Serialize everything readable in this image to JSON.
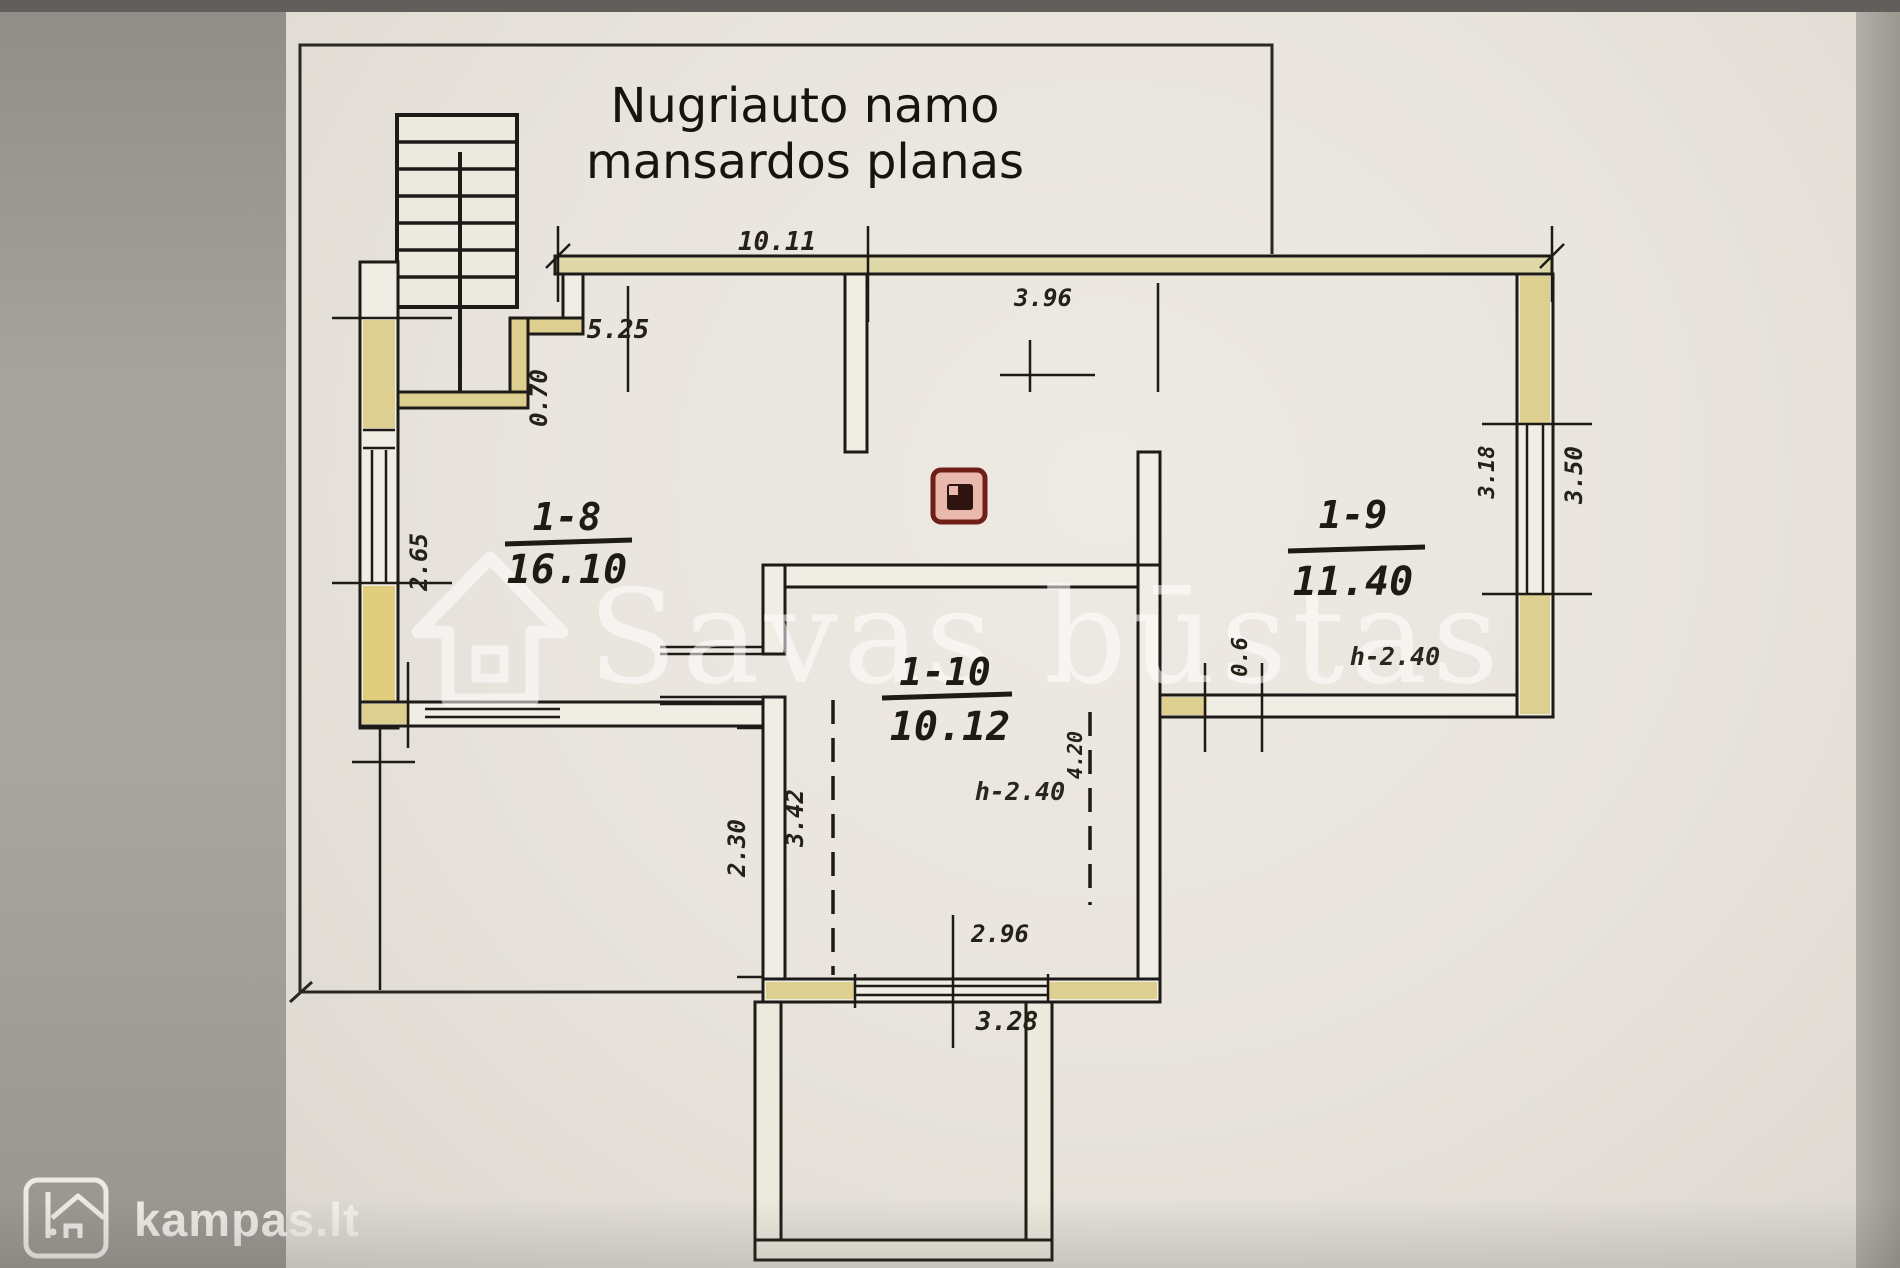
{
  "title": {
    "line1": "Nugriauto namo",
    "line2": "mansardos planas"
  },
  "watermark": {
    "text": "Savas būstas"
  },
  "logo": {
    "text": "kampas.lt"
  },
  "rooms": [
    {
      "id": "1-8",
      "area": "16.10"
    },
    {
      "id": "1-9",
      "area": "11.40",
      "height": "h-2.40"
    },
    {
      "id": "1-10",
      "area": "10.12",
      "height": "h-2.40"
    }
  ],
  "dims": {
    "top_total": "10.11",
    "hall_width": "5.25",
    "room19_width": "3.96",
    "stair_offset": "0.70",
    "window_left": "2.65",
    "window_inner": "3.18",
    "window_outer": "3.50",
    "door_small": "0.6",
    "dashed_left": "3.42",
    "dashed_right": "4.20",
    "wall_lower_left": "2.30",
    "balcony_width": "2.96",
    "bottom_total": "3.28"
  },
  "colors": {
    "paper": "#e9e5de",
    "background_gray": "#a19e98",
    "wall_yellow": "#dccf8f",
    "wall_line": "#1d1a17",
    "chimney_fill": "#e9b9ae",
    "chimney_line": "#6e1f18"
  }
}
